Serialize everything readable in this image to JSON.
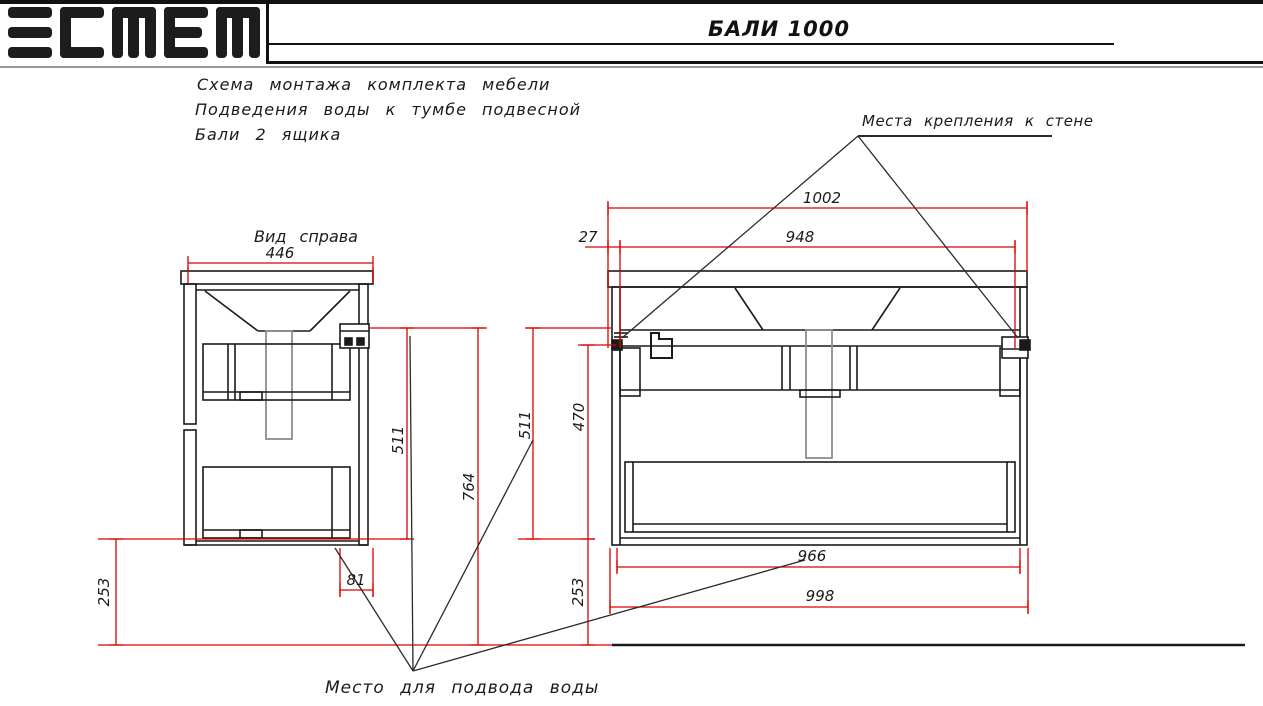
{
  "header": {
    "logo": "эстет",
    "title": "БАЛИ 1000"
  },
  "description": {
    "line1": "Схема  монтажа  комплекта  мебели",
    "line2": "Подведения  воды  к  тумбе  подвесной",
    "line3": "Бали  2  ящика"
  },
  "labels": {
    "side_view": "Вид  справа",
    "wall_mount": "Места  крепления  к  стене",
    "water_supply": "Место  для  подвода  воды"
  },
  "dims": {
    "side_width": "446",
    "side_mount_height": "511",
    "mount_height_floor": "764",
    "bottom_clearance_side": "253",
    "water_offset": "81",
    "front_overall_width": "1002",
    "mount_spacing": "948",
    "mount_edge_offset": "27",
    "front_mount_height": "511",
    "front_inner_height": "470",
    "bottom_clearance_front": "253",
    "front_inner_width": "966",
    "front_body_width": "998"
  },
  "colors": {
    "dimension_red": "#dd0000",
    "line_black": "#1a1a1a",
    "pipe_gray": "#8c8c8c",
    "logo_black": "#1d1d1b"
  }
}
